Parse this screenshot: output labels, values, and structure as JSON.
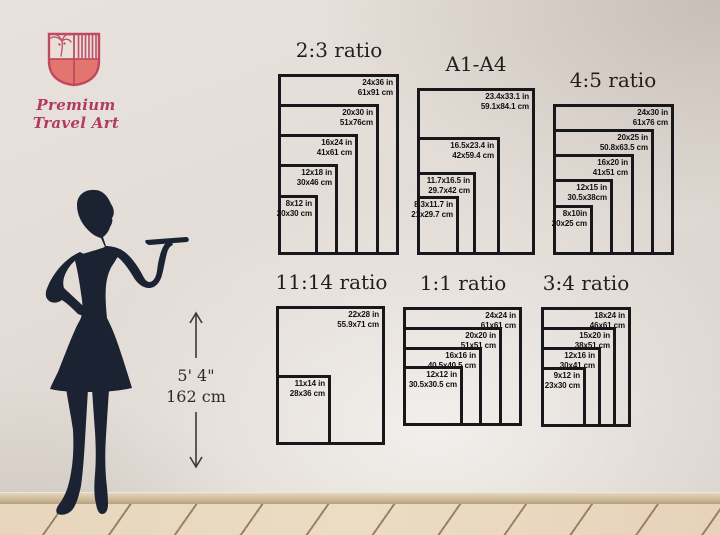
{
  "brand": {
    "name": "Premium Travel Art",
    "icon": "travel-crest-shield",
    "accent_color": "#bf4a60",
    "fill_color": "#e4756e"
  },
  "height_marker": {
    "imperial": "5' 4\"",
    "metric": "162 cm",
    "figure": "woman-silhouette"
  },
  "colors": {
    "line": "#17171c",
    "silhouette": "#1b2333",
    "wall": "#e4ddd7",
    "floor": "#e8d7bf"
  },
  "chart_data": [
    {
      "type": "nested-rectangles",
      "title": "2:3 ratio",
      "sizes": [
        {
          "in": "24x36 in",
          "cm": "61x91 cm",
          "w_in": 24,
          "h_in": 36
        },
        {
          "in": "20x30 in",
          "cm": "51x76cm",
          "w_in": 20,
          "h_in": 30
        },
        {
          "in": "16x24 in",
          "cm": "41x61 cm",
          "w_in": 16,
          "h_in": 24
        },
        {
          "in": "12x18 in",
          "cm": "30x46 cm",
          "w_in": 12,
          "h_in": 18
        },
        {
          "in": "8x12 in",
          "cm": "20x30 cm",
          "w_in": 8,
          "h_in": 12
        }
      ]
    },
    {
      "type": "nested-rectangles",
      "title": "A1-A4",
      "sizes": [
        {
          "in": "23.4x33.1 in",
          "cm": "59.1x84.1 cm",
          "w_in": 23.4,
          "h_in": 33.1
        },
        {
          "in": "16.5x23.4 in",
          "cm": "42x59.4 cm",
          "w_in": 16.5,
          "h_in": 23.4
        },
        {
          "in": "11.7x16.5 in",
          "cm": "29.7x42 cm",
          "w_in": 11.7,
          "h_in": 16.5
        },
        {
          "in": "8.3x11.7 in",
          "cm": "21x29.7 cm",
          "w_in": 8.3,
          "h_in": 11.7
        }
      ]
    },
    {
      "type": "nested-rectangles",
      "title": "4:5 ratio",
      "sizes": [
        {
          "in": "24x30 in",
          "cm": "61x76 cm",
          "w_in": 24,
          "h_in": 30
        },
        {
          "in": "20x25 in",
          "cm": "50.8x63.5 cm",
          "w_in": 20,
          "h_in": 25
        },
        {
          "in": "16x20 in",
          "cm": "41x51 cm",
          "w_in": 16,
          "h_in": 20
        },
        {
          "in": "12x15 in",
          "cm": "30.5x38cm",
          "w_in": 12,
          "h_in": 15
        },
        {
          "in": "8x10in",
          "cm": "20x25 cm",
          "w_in": 8,
          "h_in": 10
        }
      ]
    },
    {
      "type": "nested-rectangles",
      "title": "11:14 ratio",
      "sizes": [
        {
          "in": "22x28 in",
          "cm": "55.9x71 cm",
          "w_in": 22,
          "h_in": 28
        },
        {
          "in": "11x14 in",
          "cm": "28x36 cm",
          "w_in": 11,
          "h_in": 14
        }
      ]
    },
    {
      "type": "nested-rectangles",
      "title": "1:1 ratio",
      "sizes": [
        {
          "in": "24x24 in",
          "cm": "61x61 cm",
          "w_in": 24,
          "h_in": 24
        },
        {
          "in": "20x20 in",
          "cm": "51x51 cm",
          "w_in": 20,
          "h_in": 20
        },
        {
          "in": "16x16 in",
          "cm": "40.5x40.5 cm",
          "w_in": 16,
          "h_in": 16
        },
        {
          "in": "12x12 in",
          "cm": "30.5x30.5 cm",
          "w_in": 12,
          "h_in": 12
        }
      ]
    },
    {
      "type": "nested-rectangles",
      "title": "3:4 ratio",
      "sizes": [
        {
          "in": "18x24 in",
          "cm": "46x61 cm",
          "w_in": 18,
          "h_in": 24
        },
        {
          "in": "15x20 in",
          "cm": "38x51 cm",
          "w_in": 15,
          "h_in": 20
        },
        {
          "in": "12x16 in",
          "cm": "30x41 cm",
          "w_in": 12,
          "h_in": 16
        },
        {
          "in": "9x12 in",
          "cm": "23x30 cm",
          "w_in": 9,
          "h_in": 12
        }
      ]
    }
  ]
}
